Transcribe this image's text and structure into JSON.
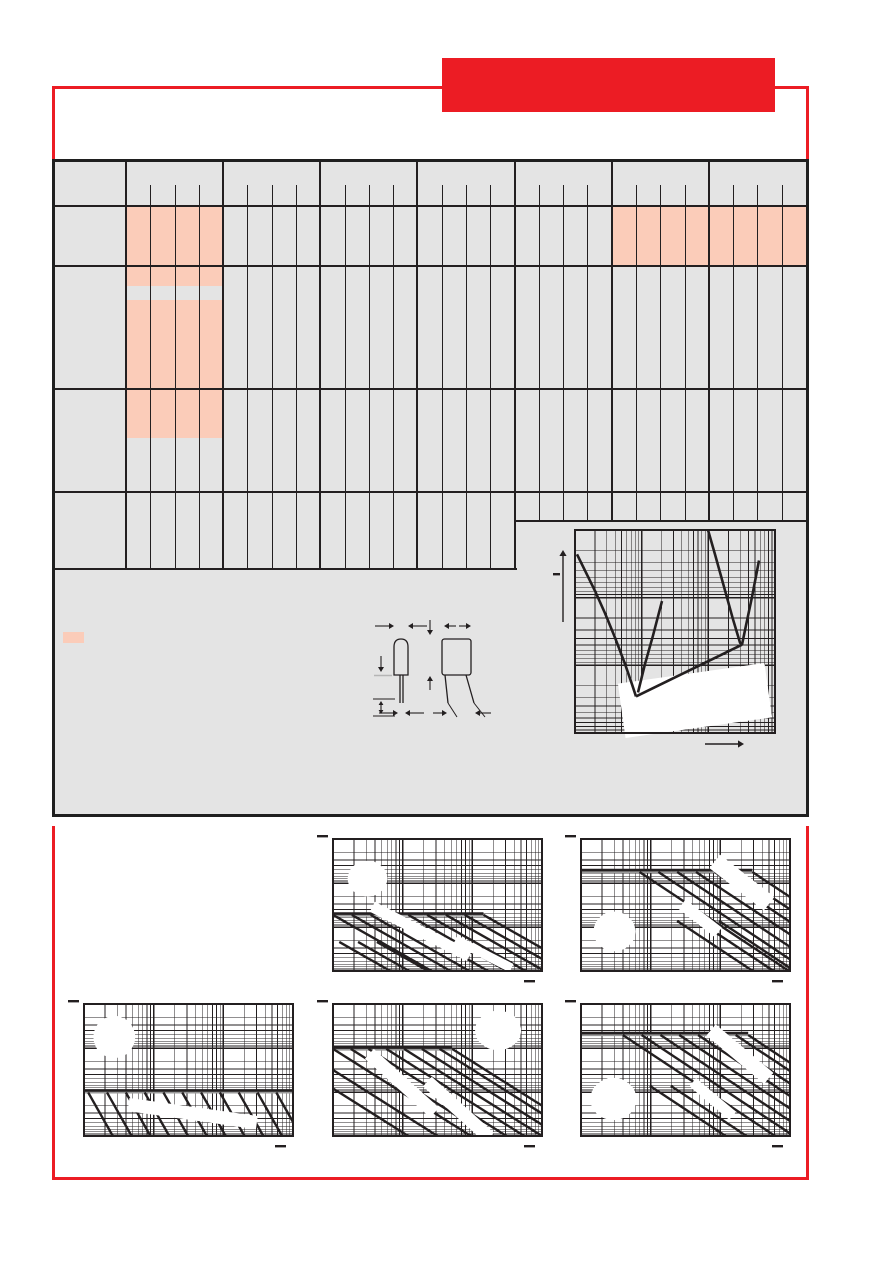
{
  "colors": {
    "accent_red": "#ec1c24",
    "panel_grey": "#e4e4e4",
    "highlight_pink": "#fbccb9",
    "line_black": "#231f20",
    "shadow_grey": "#9a9a9a",
    "patch_white": "#ffffff"
  },
  "header": {
    "banner_text": "",
    "rule_style": "red horizontal rule broken by solid red title banner, short red verticals dropping to table"
  },
  "table": {
    "label_column": true,
    "column_groups": 7,
    "subcolumns_per_group": 4,
    "row_bands": 5,
    "right_section_groups": "5-7 end one band higher than groups 1-4",
    "highlight_color": "#fbccb9",
    "highlights": [
      {
        "group": 1,
        "band": 2
      },
      {
        "group": 6,
        "band": 2
      },
      {
        "group": 7,
        "band": 2
      },
      {
        "group": 1,
        "band": "3-4 upper",
        "note": "tall block with narrow grey gap near its top"
      }
    ],
    "cell_text": ""
  },
  "legend": {
    "swatch_color": "#fbccb9",
    "label": ""
  },
  "drawing": {
    "name": "capacitor-outline-dimensions",
    "views": [
      "side view with rounded top and straight leads",
      "front view with splayed leads"
    ],
    "dimension_labels": []
  },
  "chart_data": [
    {
      "id": "impedance-vs-frequency",
      "type": "line",
      "title": "",
      "xlabel": "",
      "ylabel": "-",
      "x_axis": {
        "scale": "log",
        "decades": 3,
        "tick_labels": []
      },
      "y_axis": {
        "scale": "log",
        "decades": 3,
        "tick_labels": []
      },
      "curves": [
        {
          "name": "impedance-curve-A-falling",
          "points": [
            [
              0.01,
              0.12
            ],
            [
              0.05,
              0.2
            ],
            [
              0.1,
              0.3
            ],
            [
              0.15,
              0.41
            ],
            [
              0.2,
              0.53
            ],
            [
              0.25,
              0.66
            ],
            [
              0.285,
              0.76
            ],
            [
              0.305,
              0.82
            ]
          ]
        },
        {
          "name": "esr-diagonal",
          "points": [
            [
              0.305,
              0.82
            ],
            [
              0.835,
              0.565
            ]
          ]
        },
        {
          "name": "impedance-branch-rising",
          "points": [
            [
              0.315,
              0.8
            ],
            [
              0.35,
              0.66
            ],
            [
              0.39,
              0.52
            ],
            [
              0.435,
              0.35
            ]
          ]
        },
        {
          "name": "impedance-curve-B-falling",
          "points": [
            [
              0.665,
              0.0
            ],
            [
              0.7,
              0.12
            ],
            [
              0.745,
              0.28
            ],
            [
              0.79,
              0.44
            ],
            [
              0.825,
              0.555
            ],
            [
              0.835,
              0.565
            ]
          ]
        },
        {
          "name": "impedance-curve-B-rising",
          "points": [
            [
              0.835,
              0.565
            ],
            [
              0.855,
              0.47
            ],
            [
              0.885,
              0.33
            ],
            [
              0.92,
              0.15
            ]
          ]
        }
      ],
      "white_patches": [
        {
          "shape": "rect",
          "cx": 0.6,
          "cy": 0.84,
          "w": 0.74,
          "h": 0.27,
          "rot": -8
        }
      ]
    },
    {
      "id": "pulse-chart-top-mid",
      "type": "line",
      "title": "",
      "x_axis": {
        "scale": "log",
        "decades": 3,
        "tick_labels": []
      },
      "y_axis": {
        "scale": "log",
        "decades": 3,
        "tick_labels": []
      },
      "h_line": {
        "y": 0.565,
        "x1": 0.0,
        "x2": 0.72
      },
      "diag_slope": 0.9,
      "diagonals": [
        [
          0.0,
          0.575
        ],
        [
          0.09,
          0.575
        ],
        [
          0.18,
          0.575
        ],
        [
          0.27,
          0.575
        ],
        [
          0.36,
          0.575
        ],
        [
          0.45,
          0.575
        ],
        [
          0.54,
          0.575
        ],
        [
          0.63,
          0.575
        ],
        [
          0.72,
          0.575
        ],
        [
          0.03,
          0.78
        ],
        [
          0.12,
          0.78
        ],
        [
          0.21,
          0.78
        ]
      ],
      "white_patches": [
        {
          "shape": "ellipse",
          "cx": 0.165,
          "cy": 0.3,
          "rx": 0.095,
          "ry": 0.135
        },
        {
          "shape": "rect",
          "cx": 0.42,
          "cy": 0.7,
          "w": 0.52,
          "h": 0.085,
          "rot": 27
        },
        {
          "shape": "rect",
          "cx": 0.72,
          "cy": 0.87,
          "w": 0.3,
          "h": 0.07,
          "rot": 27
        }
      ]
    },
    {
      "id": "pulse-chart-top-right",
      "type": "line",
      "title": "",
      "x_axis": {
        "scale": "log",
        "decades": 3,
        "tick_labels": []
      },
      "y_axis": {
        "scale": "log",
        "decades": 3,
        "tick_labels": []
      },
      "h_line": {
        "y": 0.235,
        "x1": 0.0,
        "x2": 0.82
      },
      "diag_slope": 1.05,
      "diagonals": [
        [
          0.28,
          0.25
        ],
        [
          0.37,
          0.25
        ],
        [
          0.46,
          0.25
        ],
        [
          0.55,
          0.25
        ],
        [
          0.64,
          0.25
        ],
        [
          0.73,
          0.25
        ],
        [
          0.82,
          0.25
        ],
        [
          0.46,
          0.62
        ],
        [
          0.56,
          0.62
        ],
        [
          0.66,
          0.62
        ]
      ],
      "white_patches": [
        {
          "shape": "ellipse",
          "cx": 0.16,
          "cy": 0.7,
          "rx": 0.1,
          "ry": 0.15
        },
        {
          "shape": "rect",
          "cx": 0.77,
          "cy": 0.33,
          "w": 0.33,
          "h": 0.13,
          "rot": 38
        },
        {
          "shape": "rect",
          "cx": 0.57,
          "cy": 0.6,
          "w": 0.22,
          "h": 0.09,
          "rot": 38
        }
      ]
    },
    {
      "id": "pulse-chart-bottom-left",
      "type": "line",
      "title": "",
      "x_axis": {
        "scale": "log",
        "decades": 3,
        "tick_labels": []
      },
      "y_axis": {
        "scale": "log",
        "decades": 3,
        "tick_labels": []
      },
      "h_line": {
        "y": 0.655,
        "x1": 0.0,
        "x2": 1.0
      },
      "diag_slope": 2.8,
      "diagonals": [
        [
          0.02,
          0.67
        ],
        [
          0.11,
          0.67
        ],
        [
          0.2,
          0.67
        ],
        [
          0.29,
          0.67
        ],
        [
          0.38,
          0.67
        ],
        [
          0.47,
          0.67
        ],
        [
          0.56,
          0.67
        ],
        [
          0.65,
          0.67
        ],
        [
          0.74,
          0.67
        ],
        [
          0.83,
          0.67
        ],
        [
          0.92,
          0.67
        ]
      ],
      "white_patches": [
        {
          "shape": "ellipse",
          "cx": 0.145,
          "cy": 0.25,
          "rx": 0.1,
          "ry": 0.16
        },
        {
          "shape": "rect",
          "cx": 0.52,
          "cy": 0.83,
          "w": 0.62,
          "h": 0.1,
          "rot": 8
        }
      ]
    },
    {
      "id": "pulse-chart-bottom-mid",
      "type": "line",
      "title": "",
      "x_axis": {
        "scale": "log",
        "decades": 3,
        "tick_labels": []
      },
      "y_axis": {
        "scale": "log",
        "decades": 3,
        "tick_labels": []
      },
      "h_line": {
        "y": 0.33,
        "x1": 0.0,
        "x2": 0.57
      },
      "diag_slope": 1.0,
      "diagonals": [
        [
          0.0,
          0.34
        ],
        [
          0.085,
          0.34
        ],
        [
          0.17,
          0.34
        ],
        [
          0.255,
          0.34
        ],
        [
          0.34,
          0.34
        ],
        [
          0.425,
          0.34
        ],
        [
          0.51,
          0.34
        ],
        [
          0.57,
          0.34
        ],
        [
          0.0,
          0.5
        ],
        [
          0.0,
          0.64
        ]
      ],
      "white_patches": [
        {
          "shape": "ellipse",
          "cx": 0.79,
          "cy": 0.2,
          "rx": 0.11,
          "ry": 0.15
        },
        {
          "shape": "rect",
          "cx": 0.33,
          "cy": 0.6,
          "w": 0.42,
          "h": 0.1,
          "rot": 42
        },
        {
          "shape": "rect",
          "cx": 0.6,
          "cy": 0.8,
          "w": 0.4,
          "h": 0.1,
          "rot": 42
        }
      ]
    },
    {
      "id": "pulse-chart-bottom-right",
      "type": "line",
      "title": "",
      "x_axis": {
        "scale": "log",
        "decades": 3,
        "tick_labels": []
      },
      "y_axis": {
        "scale": "log",
        "decades": 3,
        "tick_labels": []
      },
      "h_line": {
        "y": 0.22,
        "x1": 0.0,
        "x2": 0.8
      },
      "diag_slope": 1.05,
      "diagonals": [
        [
          0.2,
          0.235
        ],
        [
          0.29,
          0.235
        ],
        [
          0.38,
          0.235
        ],
        [
          0.47,
          0.235
        ],
        [
          0.56,
          0.235
        ],
        [
          0.65,
          0.235
        ],
        [
          0.74,
          0.235
        ],
        [
          0.8,
          0.235
        ],
        [
          0.33,
          0.62
        ],
        [
          0.43,
          0.62
        ]
      ],
      "white_patches": [
        {
          "shape": "ellipse",
          "cx": 0.155,
          "cy": 0.72,
          "rx": 0.11,
          "ry": 0.16
        },
        {
          "shape": "rect",
          "cx": 0.76,
          "cy": 0.38,
          "w": 0.36,
          "h": 0.11,
          "rot": 40
        },
        {
          "shape": "rect",
          "cx": 0.63,
          "cy": 0.72,
          "w": 0.25,
          "h": 0.08,
          "rot": 40
        }
      ]
    }
  ]
}
